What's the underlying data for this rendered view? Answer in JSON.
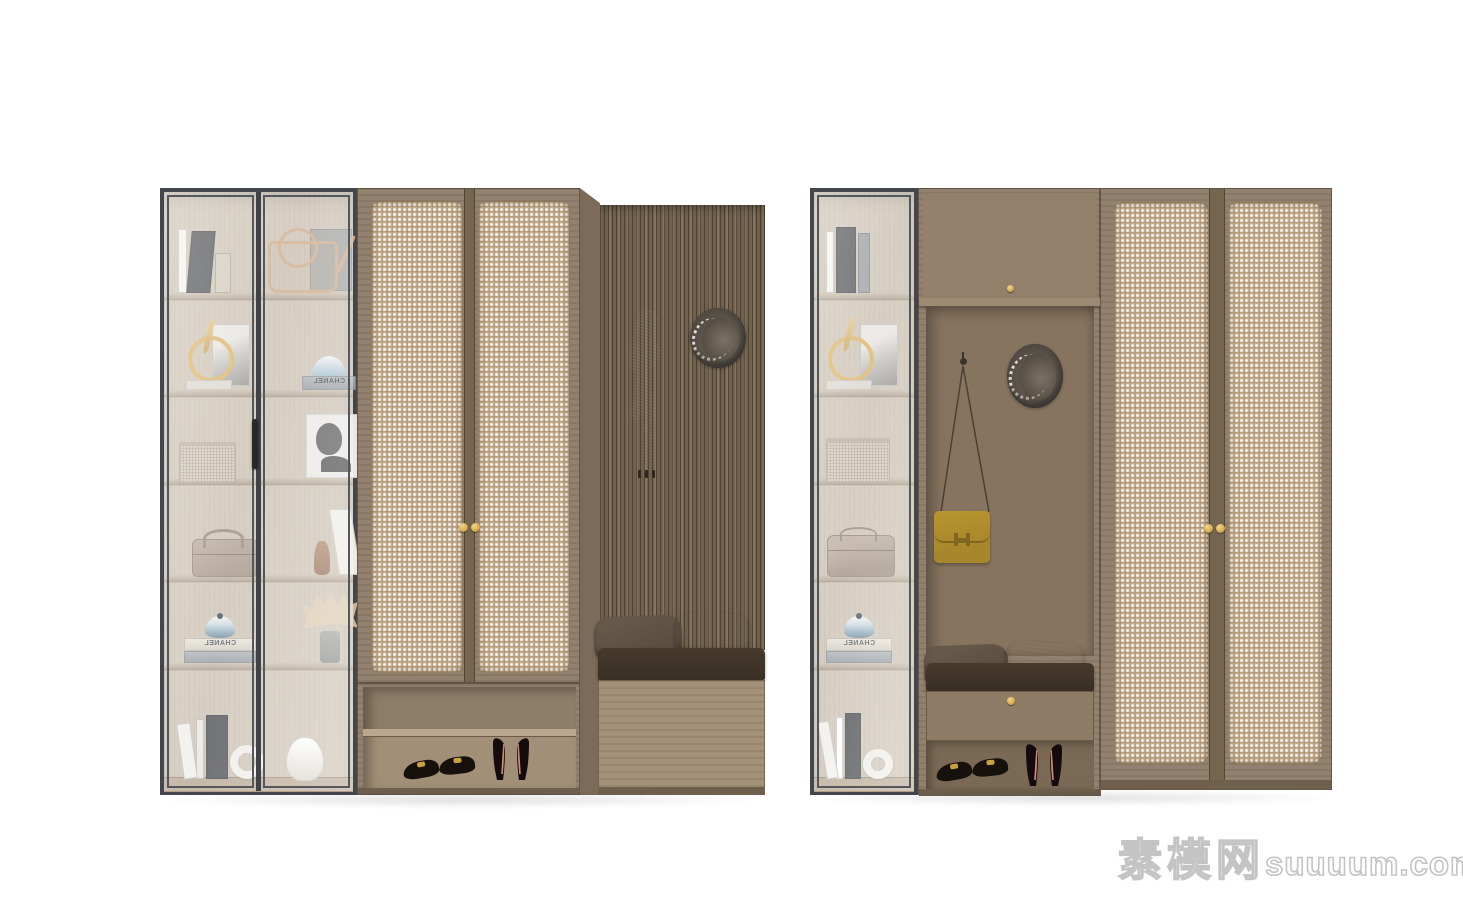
{
  "watermark": {
    "site_name_cn": "素模网",
    "site_domain": "suuuum.com"
  },
  "decor_text": {
    "chanel": "CHANEL"
  },
  "palette": {
    "bg": "#ffffff",
    "glass_frame": "#43464a",
    "cabinet_interior": "#c9bdac",
    "shelf_wood": "#b3a492",
    "rattan_frame": "#8e7d69",
    "rattan_panel": "#c4ad8c",
    "rattan_stile": "#75654f",
    "slat_dark": "#6b5c49",
    "slat_light": "#7d6d58",
    "niche_wood": "#87745f",
    "drawer_wood": "#8f7c67",
    "bench_wood": "#a18d75",
    "cushion": "#463a2d",
    "pillow_dark": "#5c4e40",
    "pillow_light": "#d8cfbc",
    "knob_gold": "#d8ab52",
    "bag_yellow": "#a8862c",
    "hat": "#575047",
    "coat": "#87817a",
    "base_dark": "#6f5f4d",
    "watermark_outline": "#c4c4c4"
  },
  "scene": {
    "description": "Two wooden entryway wardrobe units: glass display cabinets, rattan cane doors with brass knobs, open coat niches with hats and bags, upholstered shoe benches with pillows, open shoe shelves with flats and high heels",
    "left_unit": {
      "glass_cabinet_items": [
        "books",
        "gold figurine with ring and photo card",
        "woven basket",
        "portrait photo",
        "taupe handbag",
        "CHANEL book with blue lidded jar",
        "books with ring vase",
        "designer bag artwork",
        "dome hat on CHANEL book",
        "leaning book and brown bottle",
        "dried plant in gray vase",
        "round white vase"
      ],
      "wardrobe": "two rattan cane doors with twin brass knobs",
      "coat_niche_items": [
        "hanging knit scarf",
        "round woven hat"
      ],
      "bench_items": [
        "dark pillow",
        "cream pillow",
        "dark seat cushion"
      ],
      "shoe_shelf_items": [
        "black flats with gold buckles",
        "black high heels"
      ]
    },
    "right_unit": {
      "glass_cabinet_items": [
        "books",
        "gold figurine with ring and photo card",
        "woven basket",
        "taupe clutch bag",
        "CHANEL book with blue lidded jar",
        "books with ring vase"
      ],
      "upper_cabinet": "flip-up door with brass knob",
      "coat_niche_items": [
        "wall hook",
        "yellow leather bag hanging on strap",
        "round woven hat"
      ],
      "bench_items": [
        "dark pillow",
        "cream pillow",
        "dark seat cushion"
      ],
      "drawer": "full-width drawer with brass knob",
      "shoe_shelf_items": [
        "black flats with gold buckles",
        "black high heels"
      ],
      "wardrobe": "two full-height rattan cane doors with twin brass knobs"
    }
  }
}
